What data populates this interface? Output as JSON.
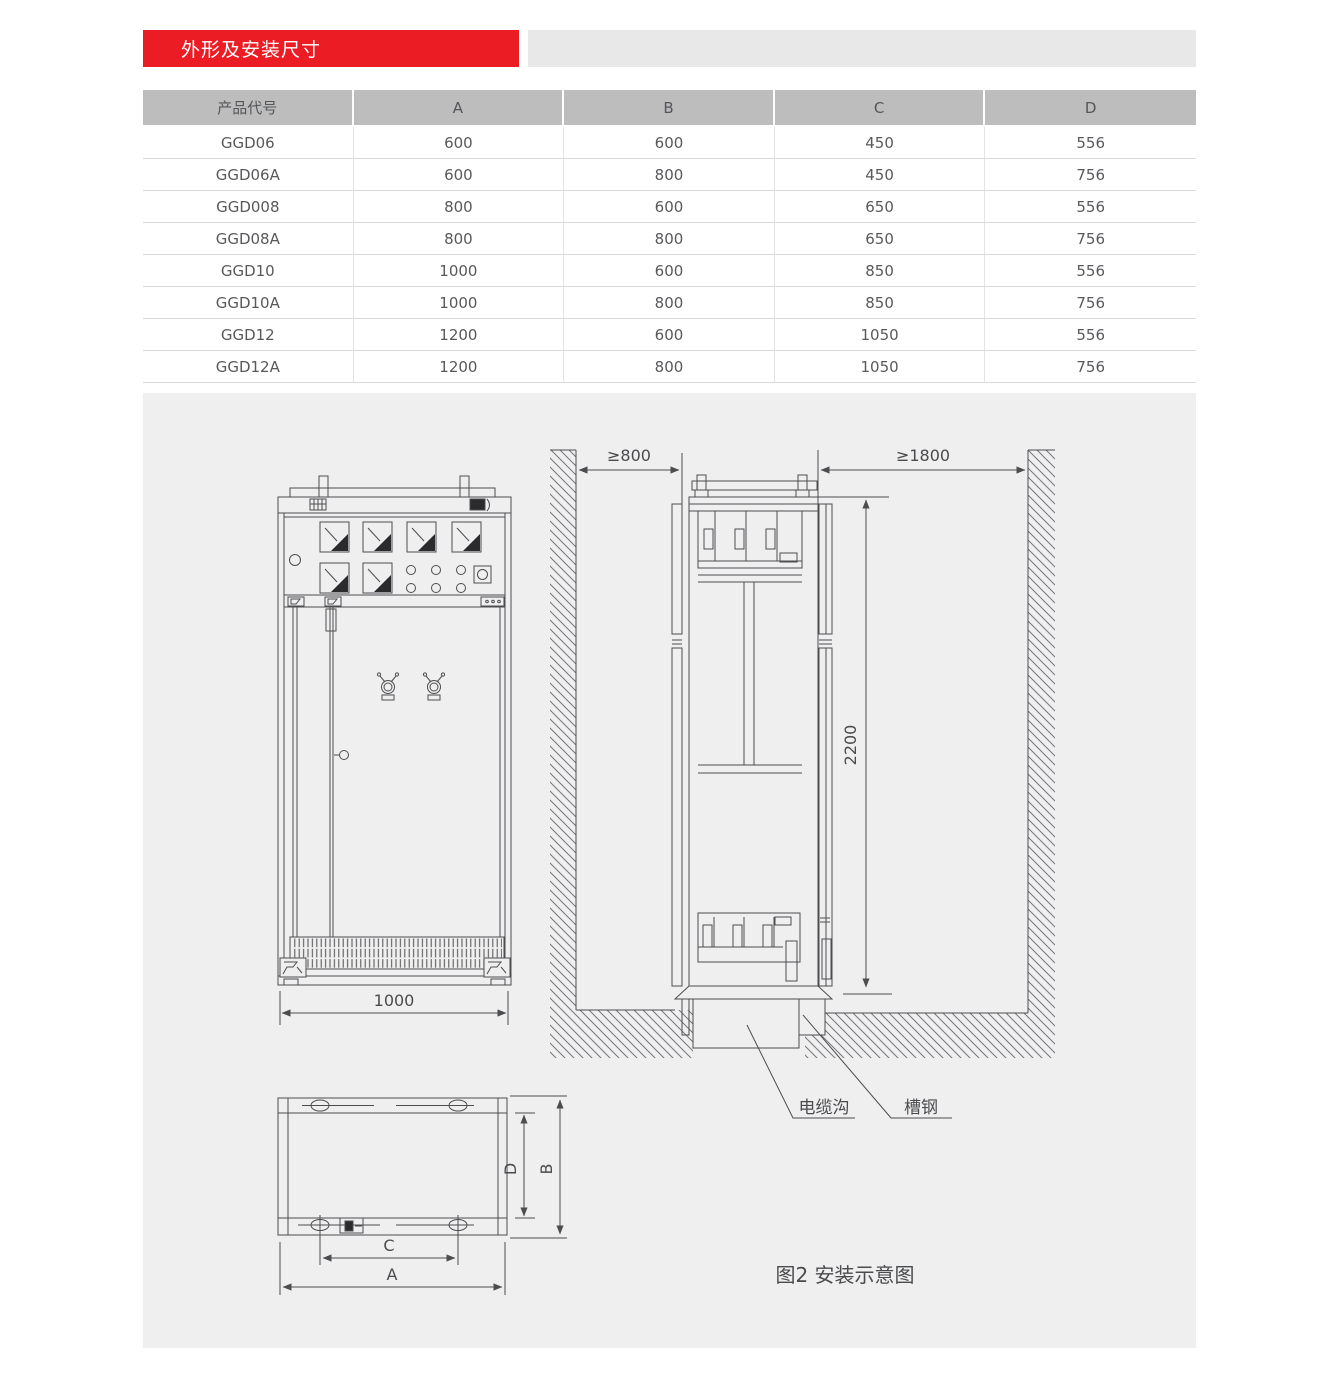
{
  "header": {
    "section_title": "外形及安装尺寸"
  },
  "table": {
    "headers": [
      "产品代号",
      "A",
      "B",
      "C",
      "D"
    ],
    "rows": [
      [
        "GGD06",
        "600",
        "600",
        "450",
        "556"
      ],
      [
        "GGD06A",
        "600",
        "800",
        "450",
        "756"
      ],
      [
        "GGD008",
        "800",
        "600",
        "650",
        "556"
      ],
      [
        "GGD08A",
        "800",
        "800",
        "650",
        "756"
      ],
      [
        "GGD10",
        "1000",
        "600",
        "850",
        "556"
      ],
      [
        "GGD10A",
        "1000",
        "800",
        "850",
        "756"
      ],
      [
        "GGD12",
        "1200",
        "600",
        "1050",
        "556"
      ],
      [
        "GGD12A",
        "1200",
        "800",
        "1050",
        "756"
      ]
    ]
  },
  "diagram": {
    "clearance_left": "≥800",
    "clearance_right": "≥1800",
    "height": "2200",
    "front_width": "1000",
    "cable_trench": "电缆沟",
    "channel_steel": "槽钢",
    "dim_a": "A",
    "dim_b": "B",
    "dim_c": "C",
    "dim_d": "D",
    "caption": "图2 安装示意图"
  },
  "colors": {
    "accent_red": "#ec1c24",
    "table_header_gray": "#bdbdbe",
    "panel_gray": "#efeff0",
    "line_gray": "#4d4d4f"
  }
}
